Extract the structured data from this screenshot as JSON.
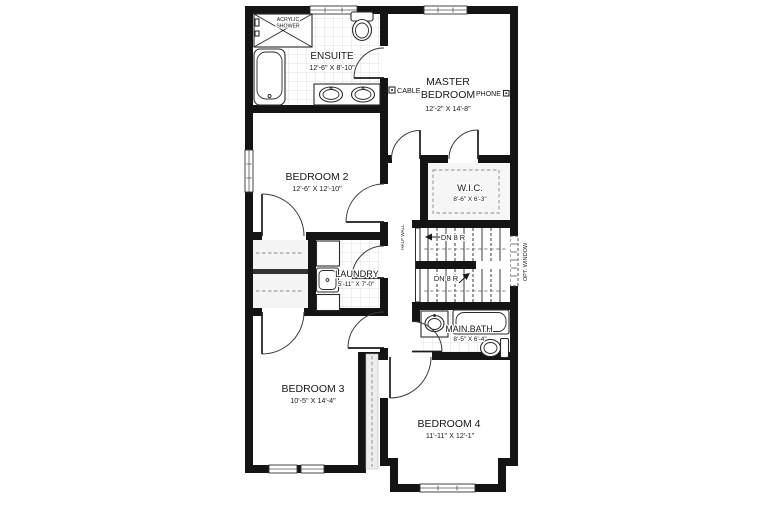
{
  "plan": {
    "rooms": {
      "ensuite": {
        "name": "ENSUITE",
        "dims": "12'-6\" X 8'-10\""
      },
      "master_bedroom": {
        "line1": "MASTER",
        "line2": "BEDROOM",
        "dims": "12'-2\" X 14'-8\""
      },
      "bedroom2": {
        "name": "BEDROOM 2",
        "dims": "12'-6\" X 12'-10\""
      },
      "wic": {
        "name": "W.I.C.",
        "dims": "8'-6\" X 6'-3\""
      },
      "laundry": {
        "name": "LAUNDRY",
        "dims": "5'-11\" X 7'-0\""
      },
      "main_bath": {
        "name": "MAIN BATH",
        "dims": "8'-5\" X 6'-4\""
      },
      "bedroom3": {
        "name": "BEDROOM 3",
        "dims": "10'-5\" X 14'-4\""
      },
      "bedroom4": {
        "name": "BEDROOM 4",
        "dims": "11'-11\" X 12'-1\""
      }
    },
    "annotations": {
      "acrylic_shower_line1": "ACRYLIC",
      "acrylic_shower_line2": "SHOWER",
      "cable": "CABLE",
      "phone": "PHONE",
      "half_wall": "HALF WALL",
      "opt_window": "OPT. WINDOW",
      "dn_upper": "DN 8 R",
      "dn_lower": "DN 8 R"
    },
    "colors": {
      "wall": "#141414",
      "tile_line": "#d9d9d9",
      "background": "#ffffff"
    }
  }
}
